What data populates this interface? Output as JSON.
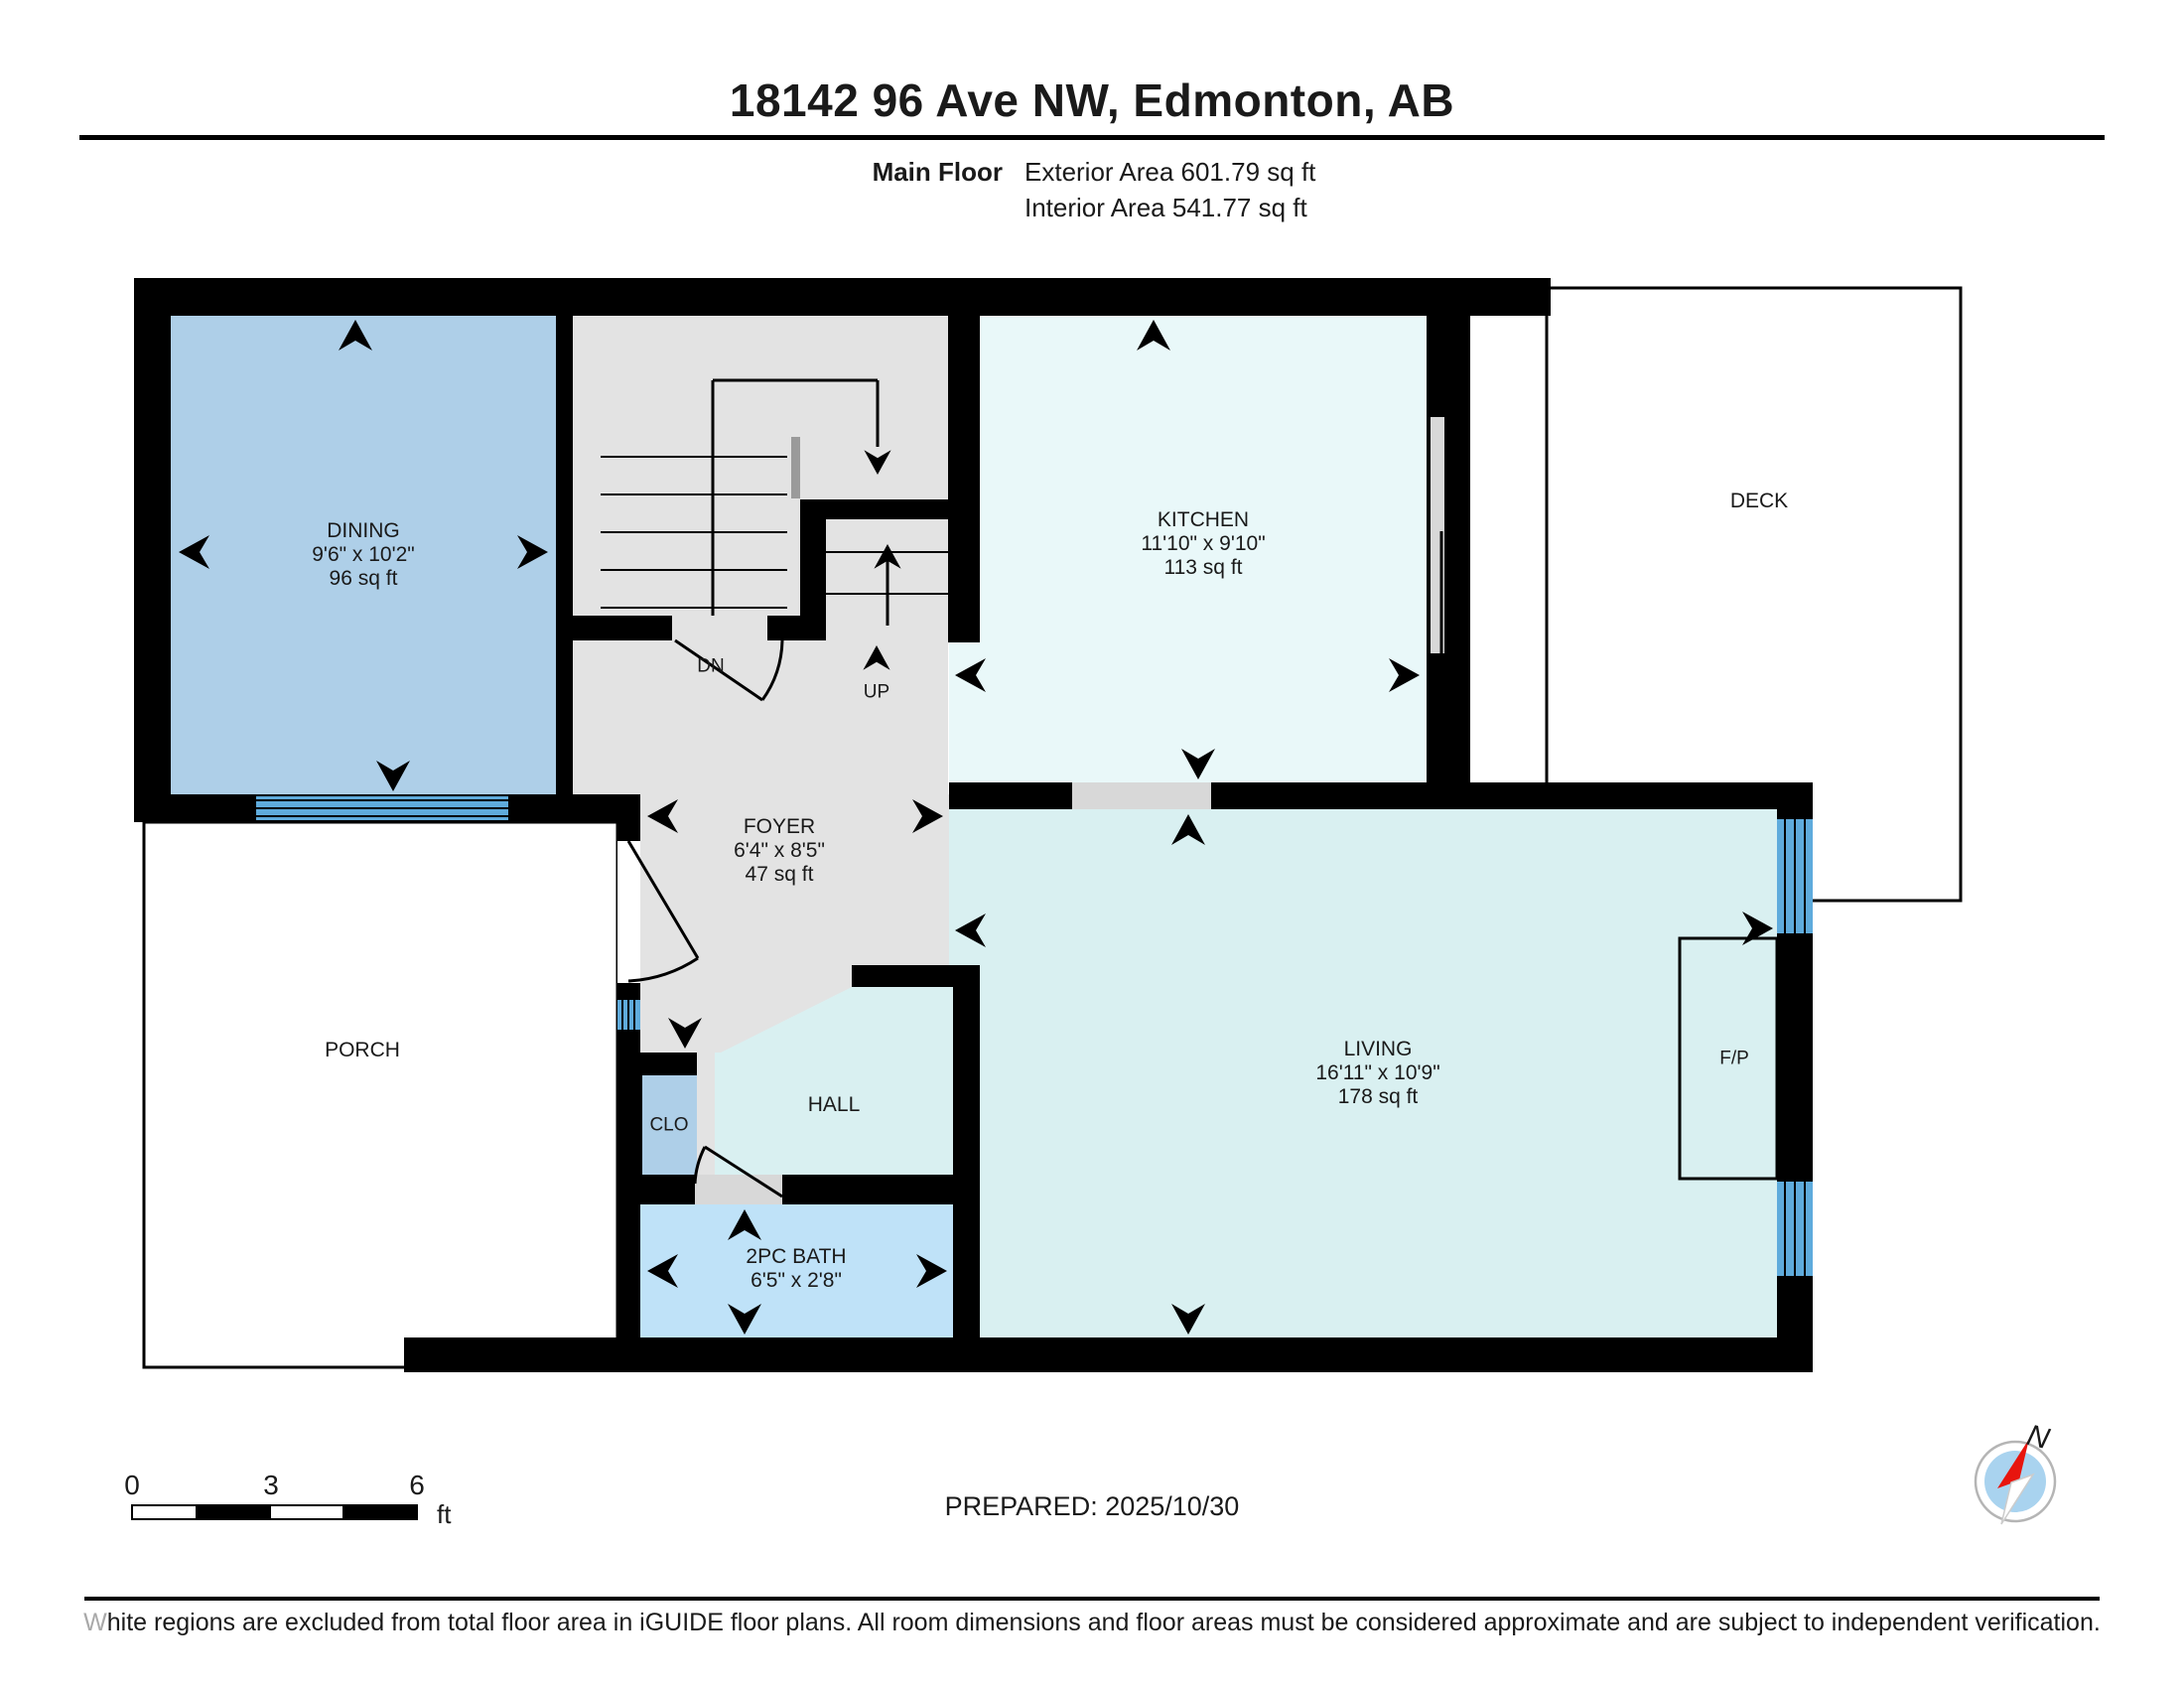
{
  "header": {
    "title": "18142 96 Ave NW, Edmonton, AB",
    "floor_label": "Main Floor",
    "exterior_area": "Exterior Area 601.79 sq ft",
    "interior_area": "Interior Area 541.77 sq ft"
  },
  "rooms": {
    "dining": {
      "name": "DINING",
      "dims": "9'6\" x 10'2\"",
      "area": "96 sq ft"
    },
    "kitchen": {
      "name": "KITCHEN",
      "dims": "11'10\" x 9'10\"",
      "area": "113 sq ft"
    },
    "living": {
      "name": "LIVING",
      "dims": "16'11\" x 10'9\"",
      "area": "178 sq ft"
    },
    "foyer": {
      "name": "FOYER",
      "dims": "6'4\" x 8'5\"",
      "area": "47 sq ft"
    },
    "bath": {
      "name": "2PC BATH",
      "dims": "6'5\" x 2'8\""
    },
    "deck": {
      "name": "DECK"
    },
    "porch": {
      "name": "PORCH"
    },
    "hall": {
      "name": "HALL"
    },
    "closet": {
      "name": "CLO"
    },
    "fireplace": {
      "name": "F/P"
    }
  },
  "stairs": {
    "down_label": "DN",
    "up_label": "UP"
  },
  "scale_bar": {
    "start": "0",
    "mid": "3",
    "end": "6",
    "unit": "ft"
  },
  "prepared": "PREPARED: 2025/10/30",
  "compass": {
    "north_label": "N"
  },
  "footer": {
    "disclaimer": "White regions are excluded from total floor area in iGUIDE floor plans. All room dimensions and floor areas must be considered approximate and are subject to independent verification."
  },
  "colors": {
    "wall": "#000000",
    "gray_floor": "#e3e3e3",
    "dining_fill": "#aecfe8",
    "closet_fill": "#aecfe8",
    "bath_fill": "#bfe2f8",
    "kitchen_fill": "#e9f8f9",
    "living_fill": "#d9f0f1",
    "window_blue": "#5fabdc",
    "opening_gray": "#d8d8d8",
    "railing_gray": "#9a9a9a",
    "compass_blue": "#a9d3ef",
    "compass_red": "#e8150e"
  }
}
